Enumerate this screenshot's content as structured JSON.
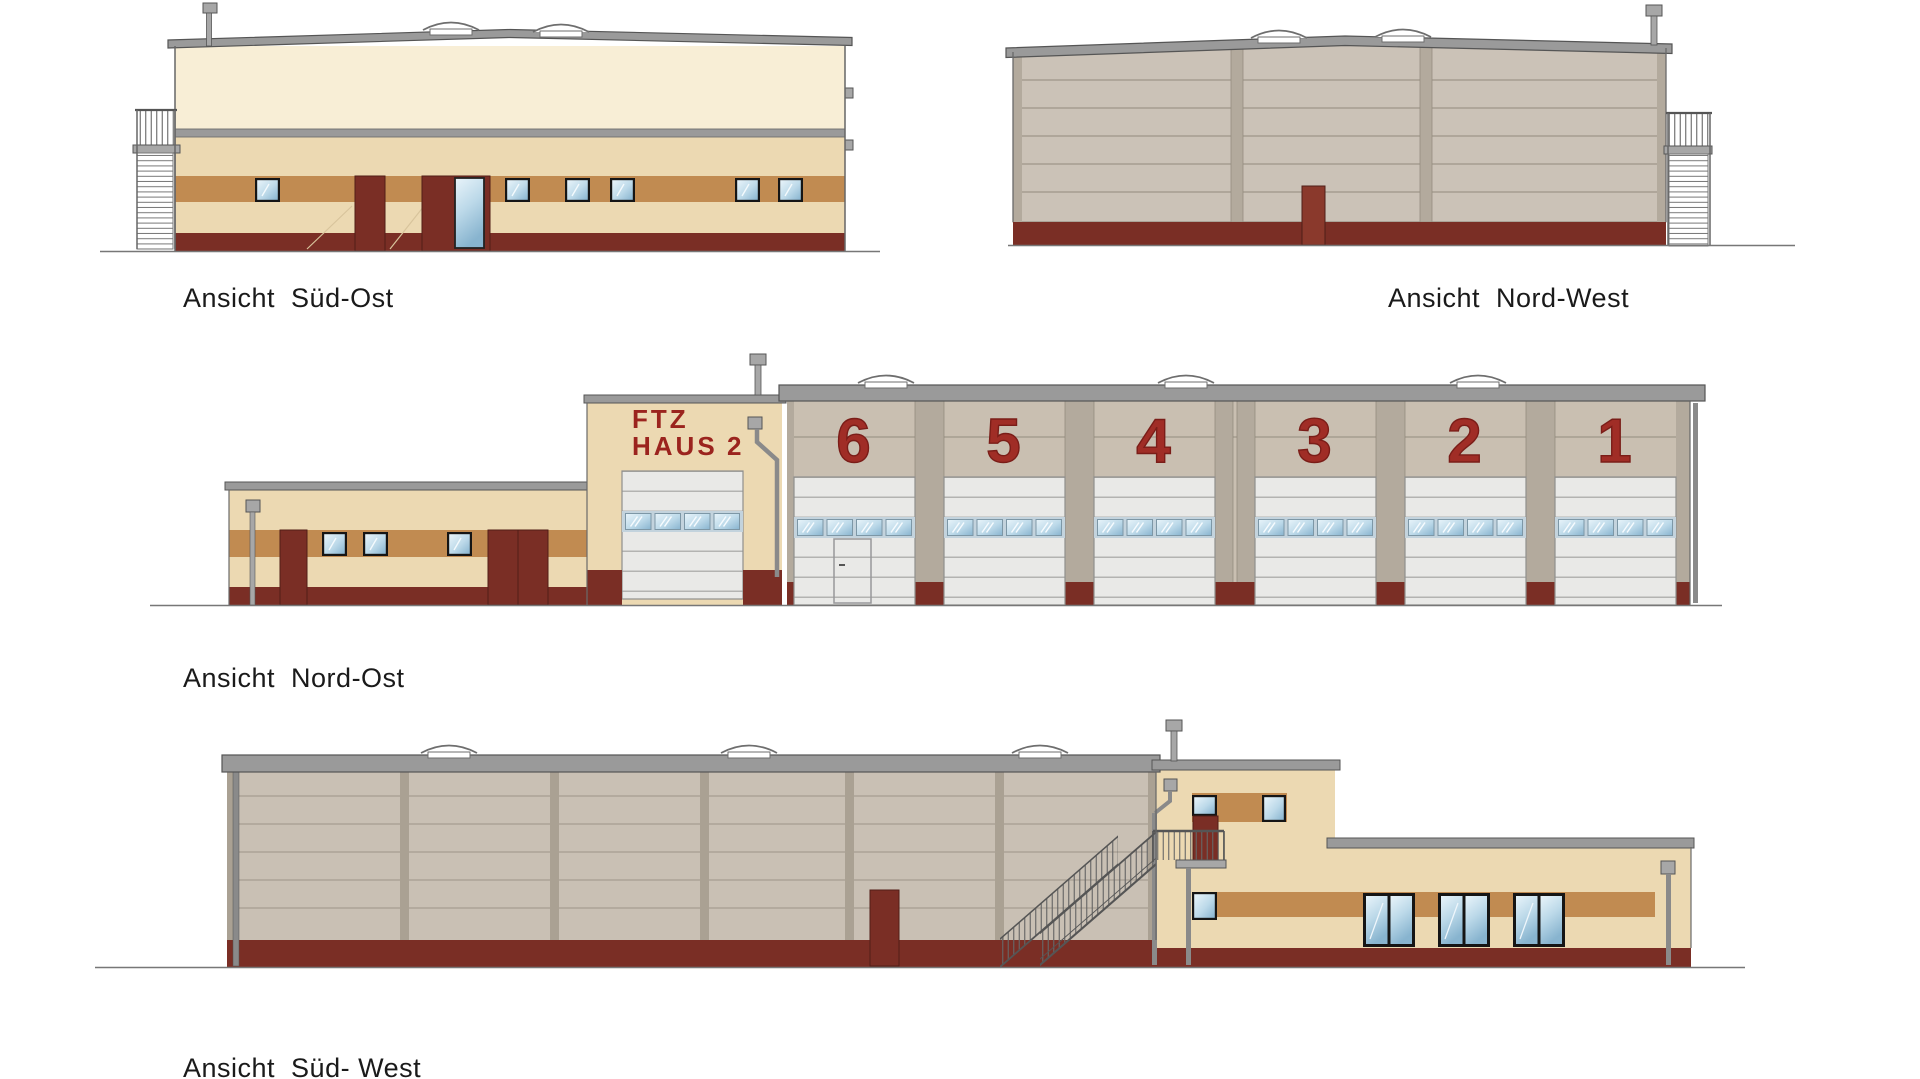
{
  "drawing": {
    "views": [
      {
        "id": "sued-ost",
        "label": "Ansicht  Süd-Ost"
      },
      {
        "id": "nord-west",
        "label": "Ansicht  Nord-West"
      },
      {
        "id": "nord-ost",
        "label": "Ansicht  Nord-Ost",
        "sign": {
          "line1": "FTZ",
          "word": "HAUS",
          "number": "2"
        },
        "bays": [
          "6",
          "5",
          "4",
          "3",
          "2",
          "1"
        ]
      },
      {
        "id": "sued-west",
        "label": "Ansicht  Süd- West"
      }
    ]
  },
  "colors": {
    "cream": "#f8eed6",
    "tan": "#ecd9b2",
    "caramel": "#c18b51",
    "base_red": "#7a2e25",
    "door_red": "#8a392c",
    "roof_gray": "#9a9a9a",
    "panel": "#cbc2b7",
    "panel_line": "#a69d90",
    "pilaster": "#b3aa9d",
    "panel2": "#c9c0b4",
    "pilaster2": "#aaa193",
    "hall_panel": "#c9bfb1",
    "slat": "#e9e9e7",
    "win_row": "#c3d3dd",
    "metal": "#a7a7a7",
    "glass_hi": "#e9f4fa",
    "glass_mid": "#bcd9e9",
    "glass_lo": "#88b4cf",
    "sign_red": "#9b241e",
    "number_red": "#a02d26",
    "label": "#1a1a1a"
  }
}
